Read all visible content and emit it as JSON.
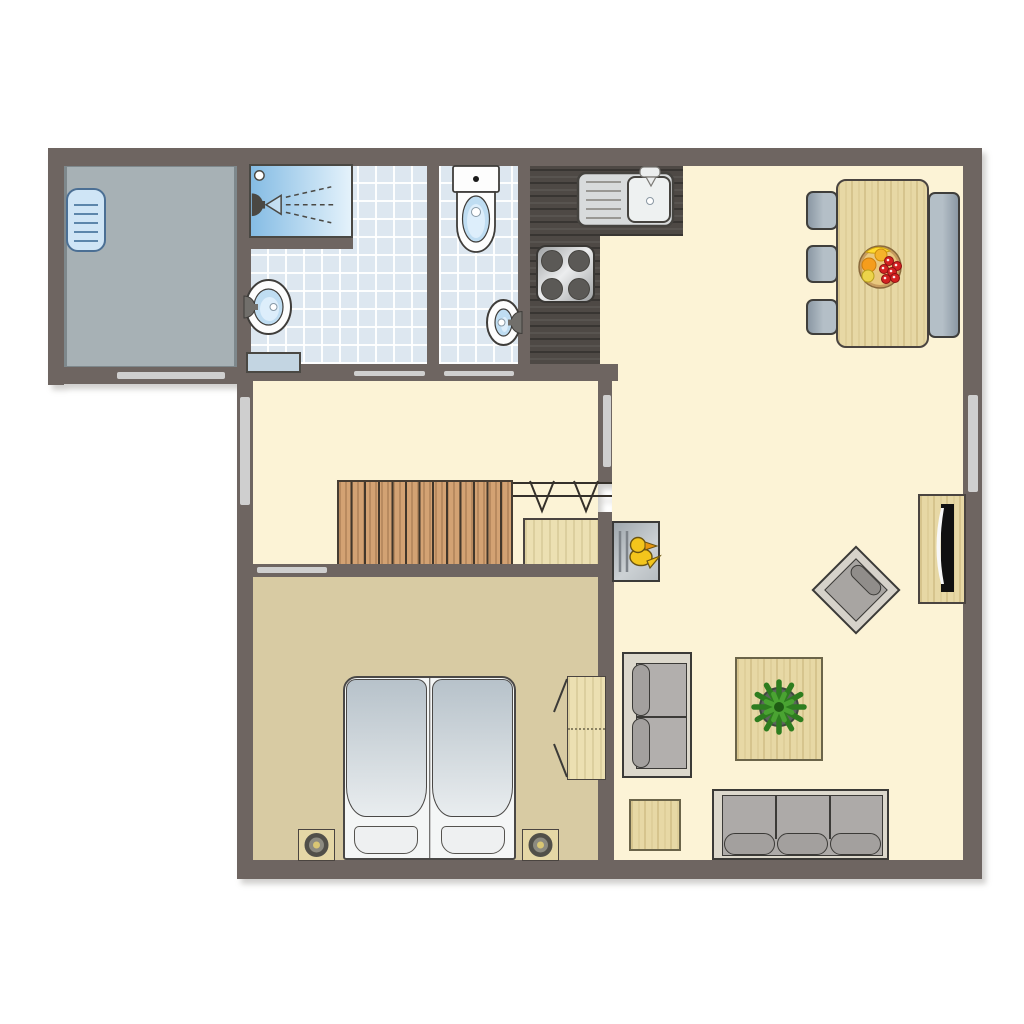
{
  "plan": {
    "canvas": {
      "w": 1024,
      "h": 1024,
      "bg": "#ffffff"
    },
    "colors": {
      "wall": "#6e6561",
      "cream": "#fcf3d6",
      "tan": "#d8cba3",
      "storageFloor": "#a7b1b5",
      "windowStrip": "#cfcfcf",
      "outline": "#3f3d3a",
      "chairLight": "#b4bfc7",
      "chairDark": "#8b98a4",
      "sofaFrame": "#dcd8cc",
      "sofaSeat": "#adaaa8",
      "cushion": "#a3a09e",
      "duvetTop": "#b7c2ca",
      "duvetBot": "#e9edef",
      "fixture": "#fdfdfd",
      "water": "#bfddf2",
      "showerFrom": "#85bce4",
      "showerTo": "#e4f2fb",
      "steel": "#d8dbdc",
      "darkCounter": "#4e4945",
      "duckYellow": "#f3c51c"
    },
    "elements": [
      {
        "t": "rect",
        "n": "storage-room-floor",
        "x": 64,
        "y": 164,
        "w": 173,
        "h": 205,
        "fill": "storageFloor",
        "border": "3px solid #7e888c"
      },
      {
        "t": "rect",
        "n": "bathroom-floor",
        "x": 249,
        "y": 164,
        "w": 178,
        "h": 202,
        "grain": "tile"
      },
      {
        "t": "rect",
        "n": "toilet-room-floor",
        "x": 439,
        "y": 164,
        "w": 79,
        "h": 202,
        "grain": "tile"
      },
      {
        "t": "rect",
        "n": "hallway-floor",
        "x": 253,
        "y": 380,
        "w": 345,
        "h": 188,
        "fill": "cream"
      },
      {
        "t": "rect",
        "n": "bedroom-floor",
        "x": 253,
        "y": 568,
        "w": 345,
        "h": 294,
        "fill": "tan"
      },
      {
        "t": "rect",
        "n": "living-room-floor",
        "x": 683,
        "y": 164,
        "w": 280,
        "h": 74,
        "fill": "cream"
      },
      {
        "t": "rect",
        "n": "living-room-floor",
        "x": 600,
        "y": 234,
        "w": 363,
        "h": 132,
        "fill": "cream"
      },
      {
        "t": "rect",
        "n": "living-room-floor",
        "x": 612,
        "y": 364,
        "w": 351,
        "h": 498,
        "fill": "cream"
      },
      {
        "t": "rect",
        "n": "kitchen-counter",
        "x": 530,
        "y": 166,
        "w": 153,
        "h": 70,
        "grain": "dark"
      },
      {
        "t": "rect",
        "n": "kitchen-counter",
        "x": 530,
        "y": 236,
        "w": 70,
        "h": 130,
        "grain": "dark"
      },
      {
        "t": "rect",
        "n": "staircase",
        "x": 337,
        "y": 480,
        "w": 176,
        "h": 88,
        "grain": "stair",
        "border": "2px solid #463c31"
      },
      {
        "t": "rect",
        "n": "understairs-closet",
        "x": 523,
        "y": 518,
        "w": 77,
        "h": 52,
        "grain": "pale",
        "border": "2px solid #4a4440"
      },
      {
        "t": "wall",
        "n": "exterior-wall-top",
        "x": 48,
        "y": 148,
        "w": 934,
        "h": 18
      },
      {
        "t": "wall",
        "n": "exterior-wall-right",
        "x": 963,
        "y": 148,
        "w": 19,
        "h": 730
      },
      {
        "t": "wall",
        "n": "exterior-wall-bottom",
        "x": 237,
        "y": 860,
        "w": 745,
        "h": 19
      },
      {
        "t": "wall",
        "n": "exterior-wall-left",
        "x": 237,
        "y": 364,
        "w": 16,
        "h": 496
      },
      {
        "t": "wall",
        "n": "storage-wall-left",
        "x": 48,
        "y": 148,
        "w": 16,
        "h": 237
      },
      {
        "t": "wall",
        "n": "storage-wall-bottom",
        "x": 48,
        "y": 367,
        "w": 205,
        "h": 17
      },
      {
        "t": "wall",
        "n": "storage-bathroom-wall",
        "x": 237,
        "y": 148,
        "w": 14,
        "h": 220
      },
      {
        "t": "wall",
        "n": "bathroom-toilet-wall",
        "x": 427,
        "y": 148,
        "w": 12,
        "h": 218
      },
      {
        "t": "wall",
        "n": "toilet-kitchen-wall",
        "x": 518,
        "y": 148,
        "w": 12,
        "h": 218
      },
      {
        "t": "wall",
        "n": "hallway-top-wall",
        "x": 237,
        "y": 364,
        "w": 381,
        "h": 17
      },
      {
        "t": "wall",
        "n": "hall-living-wall-upper",
        "x": 598,
        "y": 364,
        "w": 14,
        "h": 118
      },
      {
        "t": "wall",
        "n": "hall-living-wall-lower",
        "x": 598,
        "y": 512,
        "w": 14,
        "h": 56
      },
      {
        "t": "wall",
        "n": "bedroom-living-wall",
        "x": 598,
        "y": 566,
        "w": 16,
        "h": 296
      },
      {
        "t": "wall",
        "n": "hall-bedroom-wall",
        "x": 237,
        "y": 564,
        "w": 375,
        "h": 13
      },
      {
        "t": "wall",
        "n": "shower-wall",
        "x": 249,
        "y": 238,
        "w": 104,
        "h": 11
      },
      {
        "t": "strip",
        "n": "storage-door-threshold",
        "x": 117,
        "y": 372,
        "w": 108,
        "h": 7
      },
      {
        "t": "strip",
        "n": "bathroom-door-threshold",
        "x": 354,
        "y": 371,
        "w": 71,
        "h": 5
      },
      {
        "t": "strip",
        "n": "toilet-door-threshold",
        "x": 444,
        "y": 371,
        "w": 70,
        "h": 5
      },
      {
        "t": "strip",
        "n": "bedroom-door-threshold",
        "x": 257,
        "y": 567,
        "w": 70,
        "h": 6
      },
      {
        "t": "strip",
        "n": "hallway-window",
        "x": 240,
        "y": 397,
        "w": 10,
        "h": 108
      },
      {
        "t": "strip",
        "n": "living-room-window",
        "x": 968,
        "y": 395,
        "w": 10,
        "h": 97
      },
      {
        "t": "strip",
        "n": "wall-glass-panel",
        "x": 603,
        "y": 395,
        "w": 8,
        "h": 72
      },
      {
        "t": "radiator",
        "n": "radiator",
        "x": 66,
        "y": 188,
        "w": 40,
        "h": 64
      },
      {
        "t": "shower",
        "n": "shower",
        "x": 249,
        "y": 164,
        "w": 104,
        "h": 74
      },
      {
        "t": "rect",
        "n": "shower-step",
        "x": 246,
        "y": 352,
        "w": 55,
        "h": 21,
        "fill": "#c3d5e2",
        "border": "2px solid #4a4843"
      },
      {
        "t": "basin",
        "n": "bathroom-sink",
        "x": 245,
        "y": 279,
        "w": 47,
        "h": 56,
        "side": "left"
      },
      {
        "t": "toilet",
        "n": "toilet",
        "x": 452,
        "y": 165,
        "w": 48,
        "h": 100
      },
      {
        "t": "basin",
        "n": "toilet-sink",
        "x": 486,
        "y": 299,
        "w": 35,
        "h": 47,
        "side": "right"
      },
      {
        "t": "ksink",
        "n": "kitchen-sink",
        "x": 577,
        "y": 172,
        "w": 97,
        "h": 55
      },
      {
        "t": "stove",
        "n": "stove",
        "x": 536,
        "y": 245,
        "w": 59,
        "h": 58
      },
      {
        "t": "rails",
        "n": "stair-continuation-symbol",
        "x": 513,
        "y": 477,
        "w": 100,
        "h": 38
      },
      {
        "t": "duckcab",
        "n": "duck-cabinet",
        "x": 612,
        "y": 521,
        "w": 48,
        "h": 61
      },
      {
        "t": "rect",
        "n": "dining-table",
        "x": 836,
        "y": 179,
        "w": 93,
        "h": 169,
        "grain": "wood",
        "border": "2px solid #4a4440",
        "radius": 10
      },
      {
        "t": "chair",
        "n": "dining-chair",
        "x": 806,
        "y": 191,
        "w": 32,
        "h": 39,
        "dir": 90
      },
      {
        "t": "chair",
        "n": "dining-chair",
        "x": 806,
        "y": 245,
        "w": 32,
        "h": 38,
        "dir": 90
      },
      {
        "t": "chair",
        "n": "dining-chair",
        "x": 806,
        "y": 299,
        "w": 32,
        "h": 36,
        "dir": 90
      },
      {
        "t": "chair",
        "n": "dining-bench",
        "x": 928,
        "y": 192,
        "w": 32,
        "h": 146,
        "dir": 270
      },
      {
        "t": "fruit",
        "n": "fruit-bowl",
        "x": 858,
        "y": 245,
        "w": 44,
        "h": 44
      },
      {
        "t": "rect",
        "n": "tv-cabinet",
        "x": 918,
        "y": 494,
        "w": 48,
        "h": 110,
        "grain": "wood",
        "border": "2px solid #4a4440"
      },
      {
        "t": "tv",
        "n": "tv",
        "x": 932,
        "y": 500,
        "w": 26,
        "h": 96
      },
      {
        "t": "armchair",
        "n": "armchair",
        "x": 812,
        "y": 546,
        "w": 88,
        "h": 88,
        "side": 63
      },
      {
        "t": "loveseat",
        "n": "loveseat",
        "x": 622,
        "y": 652,
        "w": 70,
        "h": 126
      },
      {
        "t": "rect",
        "n": "coffee-table",
        "x": 735,
        "y": 657,
        "w": 88,
        "h": 104,
        "grain": "wood",
        "border": "2px solid #6b6449"
      },
      {
        "t": "plant",
        "n": "potted-plant",
        "x": 752,
        "y": 680,
        "w": 54,
        "h": 54
      },
      {
        "t": "rect",
        "n": "side-table",
        "x": 629,
        "y": 799,
        "w": 52,
        "h": 52,
        "grain": "wood",
        "border": "2px solid #6b6449"
      },
      {
        "t": "sofa",
        "n": "sofa",
        "x": 712,
        "y": 789,
        "w": 177,
        "h": 71
      },
      {
        "t": "bed",
        "n": "double-bed",
        "x": 343,
        "y": 676,
        "w": 173,
        "h": 184
      },
      {
        "t": "nightstand",
        "n": "nightstand",
        "x": 298,
        "y": 829,
        "w": 37,
        "h": 32
      },
      {
        "t": "nightstand",
        "n": "nightstand",
        "x": 522,
        "y": 829,
        "w": 37,
        "h": 32
      },
      {
        "t": "wardrobe",
        "n": "wardrobe",
        "x": 567,
        "y": 676,
        "w": 39,
        "h": 104
      },
      {
        "t": "doors",
        "n": "wardrobe-doors",
        "x": 550,
        "y": 674,
        "w": 20,
        "h": 108
      }
    ]
  }
}
